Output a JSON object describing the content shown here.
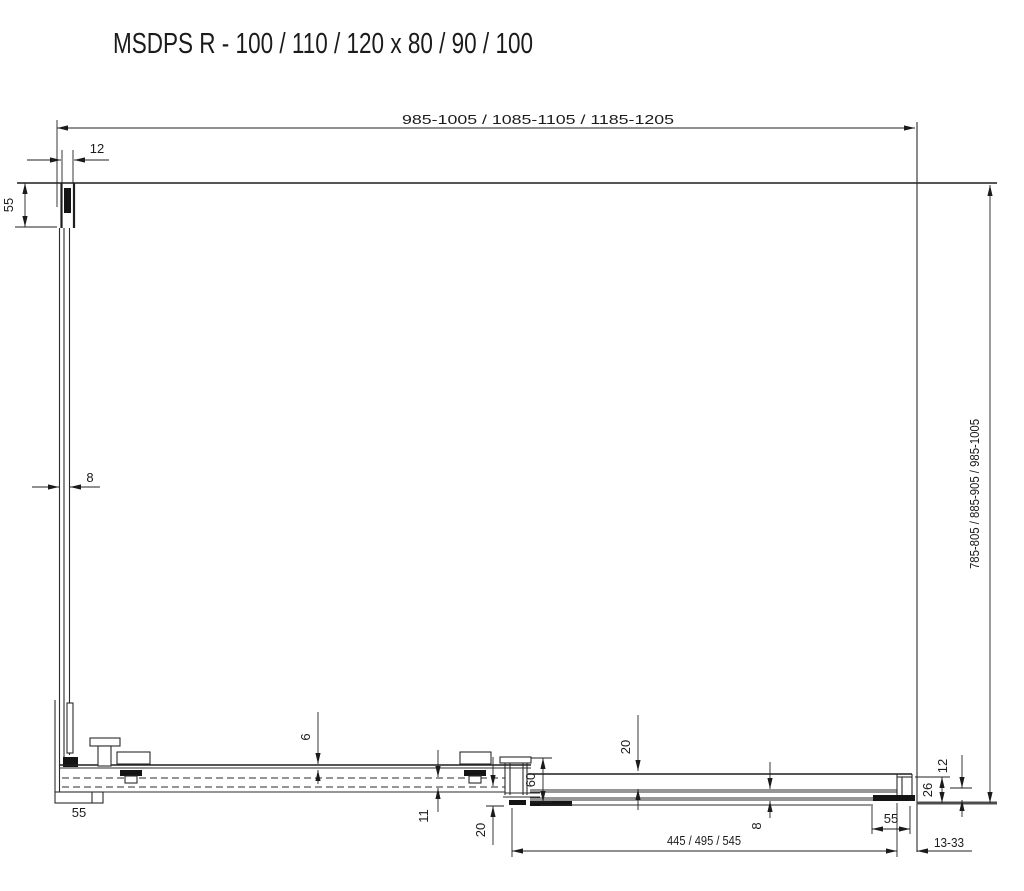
{
  "title": "MSDPS R - 100 / 110 / 120 x 80 / 90 / 100",
  "dims": {
    "top_width": "985-1005 / 1085-1105 / 1185-1205",
    "right_depth": "785-805 / 885-905 / 985-1005",
    "wall_profile_width": "12",
    "wall_profile_depth": "55",
    "side_glass_thickness": "8",
    "rail_gap": "6",
    "rail_height": "11",
    "guide_offset_left": "20",
    "stop_profile_height": "60",
    "door_rail_offset": "20",
    "door_glass_thickness": "8",
    "door_width": "445 / 495 / 545",
    "left_bracket_width": "55",
    "right_bracket_width": "55",
    "end_profile_height": "26",
    "end_profile_step": "12",
    "wall_gap_range": "13-33"
  }
}
